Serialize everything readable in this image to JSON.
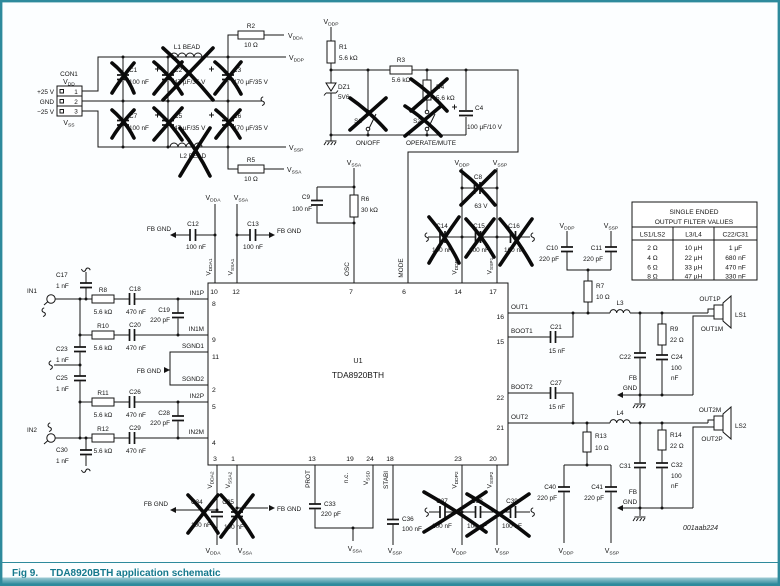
{
  "figure": {
    "caption_prefix": "Fig 9.",
    "caption": "TDA8920BTH application schematic",
    "watermark": "001aab224"
  },
  "connector": {
    "ref": "CON1",
    "pin_numbers": [
      "1",
      "2",
      "3"
    ],
    "row_labels": [
      "+25 V",
      "GND",
      "−25 V"
    ]
  },
  "nets": {
    "vdd": {
      "base": "V",
      "sub": "DD"
    },
    "vss": {
      "base": "V",
      "sub": "SS"
    },
    "vdda": {
      "base": "V",
      "sub": "DDA"
    },
    "vddp": {
      "base": "V",
      "sub": "DDP"
    },
    "vssa": {
      "base": "V",
      "sub": "SSA"
    },
    "vssp": {
      "base": "V",
      "sub": "SSP"
    },
    "vdda1": {
      "base": "V",
      "sub": "DDA1"
    },
    "vssa1": {
      "base": "V",
      "sub": "SSA1"
    },
    "vddp1": {
      "base": "V",
      "sub": "DDP1"
    },
    "vssp1": {
      "base": "V",
      "sub": "SSP1"
    },
    "vdda2": {
      "base": "V",
      "sub": "DDA2"
    },
    "vssa2": {
      "base": "V",
      "sub": "SSA2"
    },
    "vddp2": {
      "base": "V",
      "sub": "DDP2"
    },
    "vssp2": {
      "base": "V",
      "sub": "SSP2"
    },
    "vssd": {
      "base": "V",
      "sub": "SSD"
    }
  },
  "ic": {
    "ref": "U1",
    "part": "TDA8920BTH",
    "pins_top": [
      "10",
      "12",
      "7",
      "6",
      "14",
      "17"
    ],
    "pins_left": [
      "8",
      "9",
      "11",
      "2",
      "5",
      "4"
    ],
    "pins_right": [
      "16",
      "15",
      "22",
      "21"
    ],
    "pins_bottom": [
      "3",
      "1",
      "13",
      "19",
      "24",
      "18",
      "23",
      "20"
    ],
    "pin_names": {
      "osc": "OSC",
      "mode": "MODE",
      "prot": "PROT",
      "nc": "n.c.",
      "stabi": "STABI",
      "in1p": "IN1P",
      "in1m": "IN1M",
      "in2p": "IN2P",
      "in2m": "IN2M",
      "sgnd1": "SGND1",
      "sgnd2": "SGND2",
      "out1": "OUT1",
      "boot1": "BOOT1",
      "boot2": "BOOT2",
      "out2": "OUT2"
    }
  },
  "components": {
    "R1": {
      "ref": "R1",
      "value": "5.6 kΩ"
    },
    "R2": {
      "ref": "R2",
      "value": "10 Ω"
    },
    "R3": {
      "ref": "R3",
      "value": "5.6 kΩ"
    },
    "R4": {
      "ref": "R4",
      "value": "5.6 kΩ"
    },
    "R5": {
      "ref": "R5",
      "value": "10 Ω"
    },
    "R6": {
      "ref": "R6",
      "value": "30 kΩ"
    },
    "R7": {
      "ref": "R7",
      "value": "10 Ω"
    },
    "R8": {
      "ref": "R8",
      "value": "5.6 kΩ"
    },
    "R9": {
      "ref": "R9",
      "value": "22 Ω"
    },
    "R10": {
      "ref": "R10",
      "value": "5.6 kΩ"
    },
    "R11": {
      "ref": "R11",
      "value": "5.6 kΩ"
    },
    "R12": {
      "ref": "R12",
      "value": "5.6 kΩ"
    },
    "R13": {
      "ref": "R13",
      "value": "10 Ω"
    },
    "R14": {
      "ref": "R14",
      "value": "22 Ω"
    },
    "C1": {
      "ref": "C1",
      "value": "100 nF"
    },
    "C2": {
      "ref": "C2",
      "value": "47 µF/35 V"
    },
    "C3": {
      "ref": "C3",
      "value": "470 µF/35 V"
    },
    "C4": {
      "ref": "C4",
      "value": "100 µF/10 V"
    },
    "C5": {
      "ref": "C5",
      "value": "47 µF/35 V"
    },
    "C6": {
      "ref": "C6",
      "value": "470 µF/35 V"
    },
    "C7": {
      "ref": "C7",
      "value": "100 nF"
    },
    "C8": {
      "ref": "C8",
      "value": "63 V"
    },
    "C9": {
      "ref": "C9",
      "value": "100 nF"
    },
    "C10": {
      "ref": "C10",
      "value": "220 pF"
    },
    "C11": {
      "ref": "C11",
      "value": "220 pF"
    },
    "C12": {
      "ref": "C12",
      "value": "100 nF"
    },
    "C13": {
      "ref": "C13",
      "value": "100 nF"
    },
    "C14": {
      "ref": "C14",
      "value": "100 nF"
    },
    "C15": {
      "ref": "C15",
      "value": "100 nF"
    },
    "C16": {
      "ref": "C16",
      "value": "100 nF"
    },
    "C17": {
      "ref": "C17",
      "value": "1 nF"
    },
    "C18": {
      "ref": "C18",
      "value": "470 nF"
    },
    "C19": {
      "ref": "C19",
      "value": "220 pF"
    },
    "C20": {
      "ref": "C20",
      "value": "470 nF"
    },
    "C21": {
      "ref": "C21",
      "value": "15 nF"
    },
    "C22": {
      "ref": "C22"
    },
    "C23": {
      "ref": "C23",
      "value": "1 nF"
    },
    "C24": {
      "ref": "C24",
      "value_l1": "100",
      "value_l2": "nF"
    },
    "C25": {
      "ref": "C25",
      "value": "1 nF"
    },
    "C26": {
      "ref": "C26",
      "value": "470 nF"
    },
    "C27": {
      "ref": "C27",
      "value": "15 nF"
    },
    "C28": {
      "ref": "C28",
      "value": "220 pF"
    },
    "C29": {
      "ref": "C29",
      "value": "470 nF"
    },
    "C30": {
      "ref": "C30",
      "value": "1 nF"
    },
    "C31": {
      "ref": "C31"
    },
    "C32": {
      "ref": "C32",
      "value_l1": "100",
      "value_l2": "nF"
    },
    "C33": {
      "ref": "C33",
      "value": "220 pF"
    },
    "C34": {
      "ref": "C34",
      "value": "100 nF"
    },
    "C35": {
      "ref": "C35",
      "value": "100 nF"
    },
    "C36": {
      "ref": "C36",
      "value": "100 nF"
    },
    "C37": {
      "ref": "C37",
      "value": "100 nF"
    },
    "C38": {
      "ref": "C38",
      "value": "100 nF"
    },
    "C39": {
      "ref": "C39",
      "value": "100 nF"
    },
    "C40": {
      "ref": "C40",
      "value": "220 pF"
    },
    "C41": {
      "ref": "C41",
      "value": "220 pF"
    },
    "DZ1": {
      "ref": "DZ1",
      "value": "5V6"
    },
    "L1": {
      "ref": "L1 BEAD"
    },
    "L2": {
      "ref": "L2 BEAD"
    },
    "L3": {
      "ref": "L3"
    },
    "L4": {
      "ref": "L4"
    },
    "S1": {
      "ref": "S1",
      "label": "ON/OFF"
    },
    "S2": {
      "ref": "S2",
      "label": "OPERATE/MUTE"
    },
    "LS1": {
      "ref": "LS1"
    },
    "LS2": {
      "ref": "LS2"
    }
  },
  "io": {
    "in1": "IN1",
    "in2": "IN2",
    "out1p": "OUT1P",
    "out1m": "OUT1M",
    "out2m": "OUT2M",
    "out2p": "OUT2P",
    "fb_gnd": "FB GND",
    "fb": "FB",
    "gnd": "GND"
  },
  "filter_table": {
    "title_line1": "SINGLE ENDED",
    "title_line2": "OUTPUT FILTER VALUES",
    "columns": [
      "LS1/LS2",
      "L3/L4",
      "C22/C31"
    ],
    "rows": [
      [
        "2 Ω",
        "10 µH",
        "1 µF"
      ],
      [
        "4 Ω",
        "22 µH",
        "680 nF"
      ],
      [
        "6 Ω",
        "33 µH",
        "470 nF"
      ],
      [
        "8 Ω",
        "47 µH",
        "330 nF"
      ]
    ]
  },
  "crossed_out": [
    "C1",
    "C2",
    "C3",
    "C5",
    "C6",
    "C7",
    "L1",
    "L2",
    "R4",
    "S1",
    "S2",
    "C8",
    "C14",
    "C15",
    "C16",
    "C34",
    "C35",
    "C37",
    "C38",
    "C39"
  ]
}
